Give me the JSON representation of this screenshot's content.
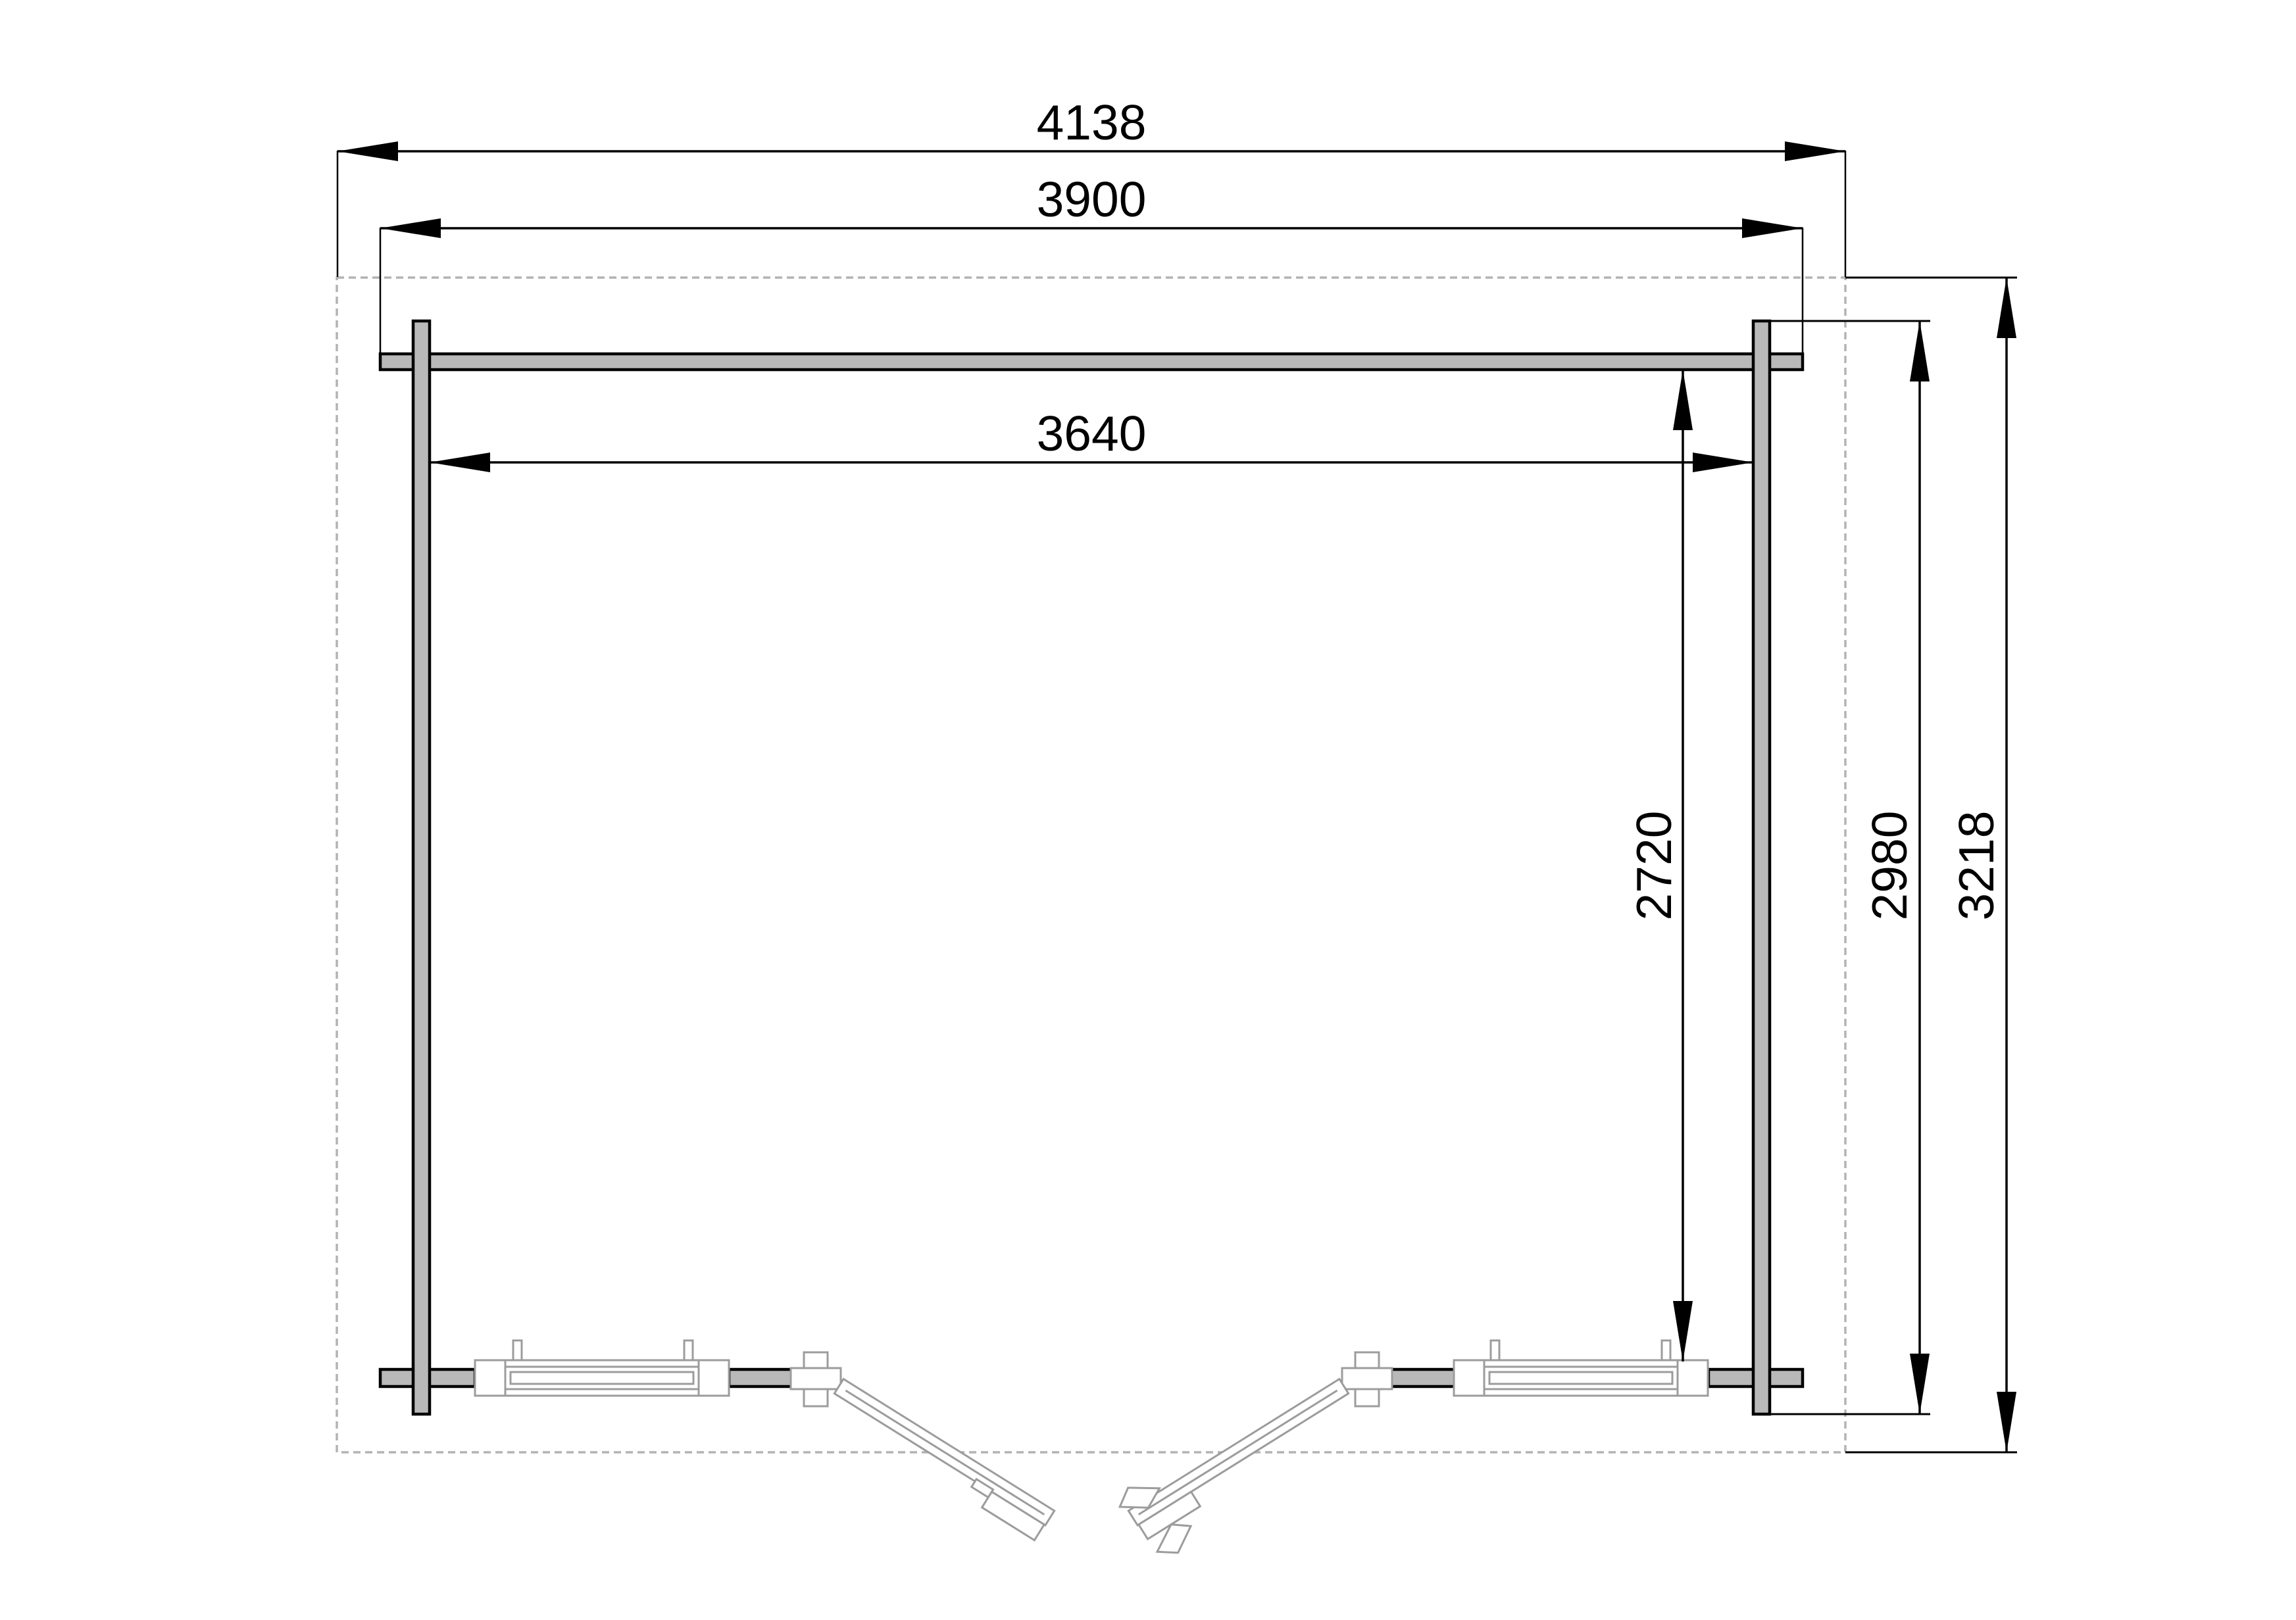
{
  "drawing": {
    "title": "log-cabin floor plan with dimensions (mm)",
    "units": "mm",
    "dims": {
      "roof_width": {
        "value": "4138",
        "orientation": "horizontal",
        "measures": "overall roof width"
      },
      "log_length": {
        "value": "3900",
        "orientation": "horizontal",
        "measures": "front/back wall log length"
      },
      "interior_width": {
        "value": "3640",
        "orientation": "horizontal",
        "measures": "inner width between side walls"
      },
      "interior_depth": {
        "value": "2720",
        "orientation": "vertical",
        "measures": "inner depth between walls"
      },
      "wall_depth": {
        "value": "2980",
        "orientation": "vertical",
        "measures": "side wall log length"
      },
      "roof_depth": {
        "value": "3218",
        "orientation": "vertical",
        "measures": "overall roof depth"
      }
    },
    "colors": {
      "log_fill": "#b9b9b9",
      "outline": "#000000",
      "roof_dash": "#b3b3b3",
      "joinery_gray": "#9c9c9c",
      "background": "#ffffff"
    },
    "features": {
      "roof_outline": "dashed overhang rectangle",
      "walls": "log walls crossing at corners",
      "double_door": "two leaves shown open at bottom center",
      "windows": "two fixed window assemblies in bottom wall"
    }
  }
}
